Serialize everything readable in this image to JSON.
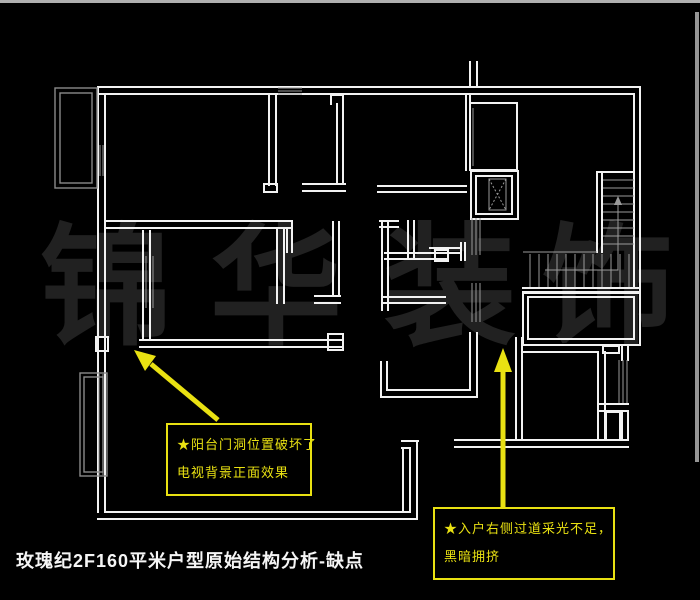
{
  "colors": {
    "background": "#000000",
    "wall": "#f2f2f2",
    "secondary_line": "#9a9a9a",
    "annotation_yellow": "#e9e112",
    "watermark": "#212121",
    "title_text": "#f5f5f5",
    "frame_strip": "#b0b0b0"
  },
  "watermark": {
    "characters": [
      "锦",
      "华",
      "装",
      "饰"
    ]
  },
  "title": {
    "text": "玫瑰纪2F160平米户型原始结构分析-缺点"
  },
  "annotations": {
    "balcony_door": {
      "lines": [
        "★阳台门洞位置破坏了",
        "电视背景正面效果"
      ]
    },
    "entry_corridor": {
      "lines": [
        "★入户右侧过道采光不足，",
        "黑暗拥挤"
      ]
    }
  }
}
